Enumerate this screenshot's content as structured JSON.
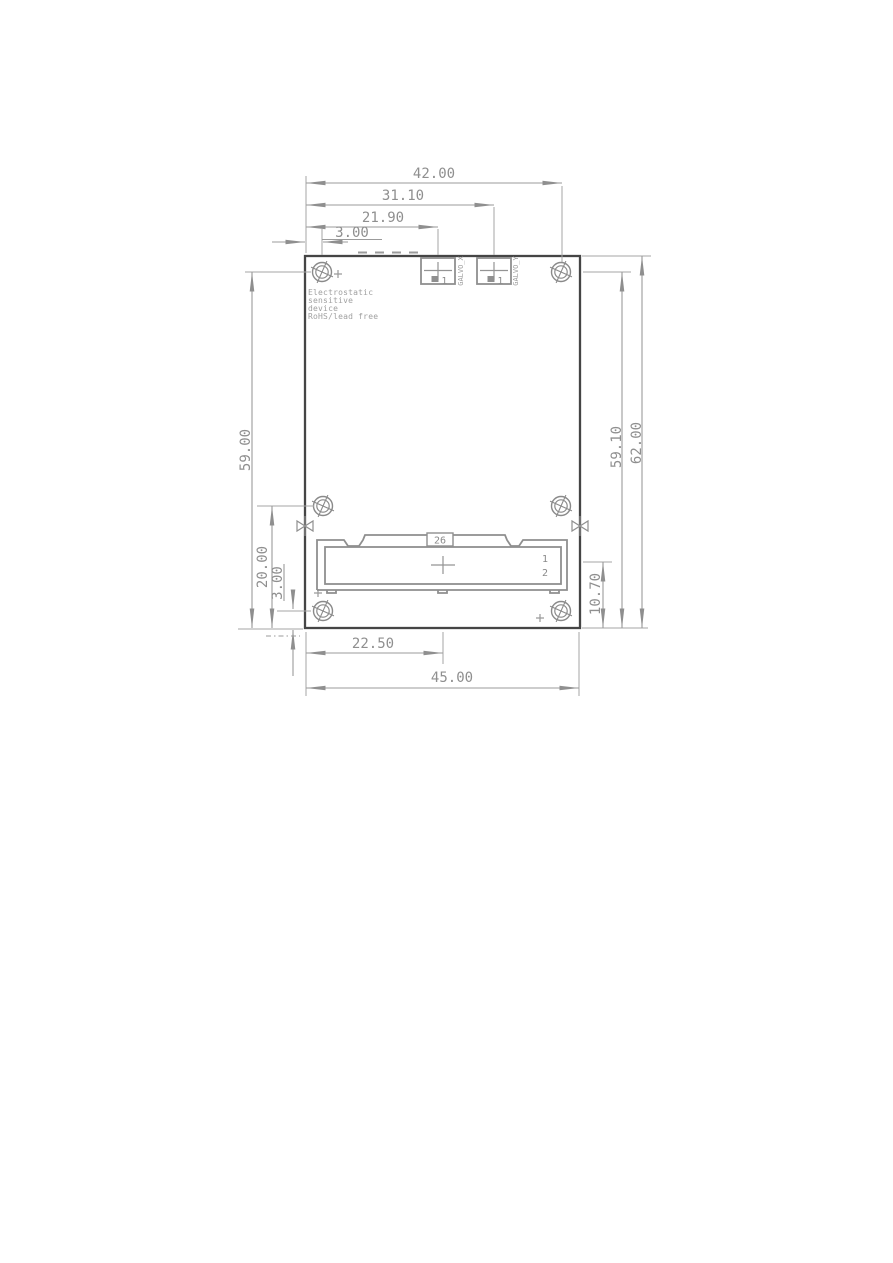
{
  "drawing": {
    "type": "pcb-mechanical-dimension-drawing",
    "units": "mm",
    "colors": {
      "board_outline": "#454545",
      "dimension_lines": "#9b9b9b",
      "dimension_text": "#8f8f8f",
      "connector_lines": "#8f8f8f",
      "silkscreen_text": "#a0a0a0",
      "background": "#ffffff"
    },
    "dims": {
      "top": [
        {
          "id": "left-edge-to-right-hole",
          "label": "42.00"
        },
        {
          "id": "left-edge-to-galvo-y",
          "label": "31.10"
        },
        {
          "id": "left-edge-to-galvo-x",
          "label": "21.90"
        },
        {
          "id": "left-edge-to-left-hole",
          "label": "3.00"
        }
      ],
      "left": [
        {
          "id": "top-hole-to-bottom-edge",
          "label": "59.00"
        },
        {
          "id": "mid-hole-to-bottom-edge",
          "label": "20.00"
        },
        {
          "id": "bottom-hole-to-bottom-edge",
          "label": "3.00"
        }
      ],
      "right": [
        {
          "id": "board-height",
          "label": "62.00"
        },
        {
          "id": "top-hole-to-bottom",
          "label": "59.10"
        },
        {
          "id": "connector-to-bottom",
          "label": "10.70"
        }
      ],
      "bottom": [
        {
          "id": "left-edge-to-connector-center",
          "label": "22.50"
        },
        {
          "id": "board-width",
          "label": "45.00"
        }
      ]
    },
    "board_text": {
      "lines": [
        "Electrostatic",
        "sensitive",
        "device",
        "RoHS/lead free"
      ]
    },
    "connectors": {
      "galvo_x": {
        "ref": "GALVO_X",
        "pin1": "1"
      },
      "galvo_y": {
        "ref": "GALVO_Y",
        "pin1": "1"
      },
      "main": {
        "designator": "26",
        "pin_top": "1",
        "pin_bottom": "2"
      }
    }
  }
}
